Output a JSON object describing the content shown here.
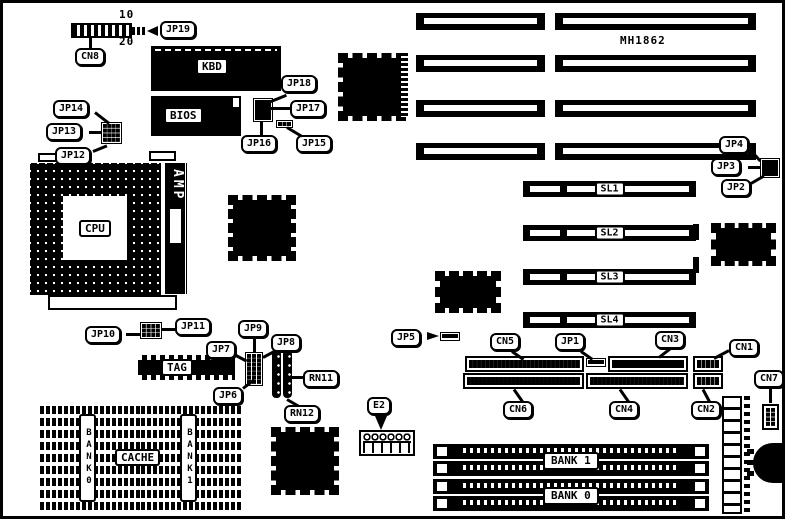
{
  "diagram": {
    "board_model": "MH1862",
    "colors": {
      "ink": "#000000",
      "paper": "#ffffff"
    }
  },
  "labels": {
    "jp19": "JP19",
    "cn8": "CN8",
    "pin10": "10",
    "pin20": "20",
    "kbd": "KBD",
    "bios": "BIOS",
    "jp18": "JP18",
    "jp17": "JP17",
    "jp16": "JP16",
    "jp15": "JP15",
    "jp14": "JP14",
    "jp13": "JP13",
    "jp12": "JP12",
    "cpu": "CPU",
    "amp": "AMP",
    "mh1862": "MH1862",
    "jp4": "JP4",
    "jp3": "JP3",
    "jp2": "JP2",
    "sl1": "SL1",
    "sl2": "SL2",
    "sl3": "SL3",
    "sl4": "SL4",
    "jp10": "JP10",
    "jp11": "JP11",
    "jp9": "JP9",
    "jp7": "JP7",
    "jp8": "JP8",
    "jp6": "JP6",
    "tag": "TAG",
    "rn11": "RN11",
    "rn12": "RN12",
    "jp5": "JP5",
    "cn5": "CN5",
    "jp1": "JP1",
    "cn3": "CN3",
    "cn1": "CN1",
    "cn6": "CN6",
    "cn4": "CN4",
    "cn2": "CN2",
    "cn7": "CN7",
    "e2": "E2",
    "cache": "CACHE",
    "bank0_vertical": "BANK0",
    "bank1_vertical": "BANK1",
    "simm_bank1": "BANK 1",
    "simm_bank0": "BANK 0"
  }
}
